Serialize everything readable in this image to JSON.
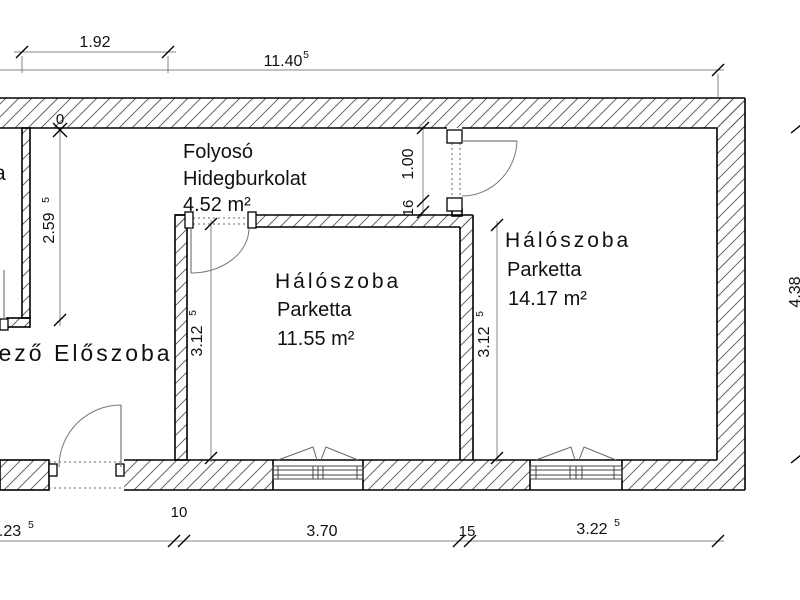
{
  "drawing_type": "floor-plan",
  "rooms": {
    "folyoso": {
      "name": "Folyosó",
      "finish": "Hidegburkolat",
      "area": "4.52 m²"
    },
    "haloszoba1": {
      "name": "Hálószoba",
      "finish": "Parketta",
      "area": "11.55 m²"
    },
    "haloszoba2": {
      "name": "Hálószoba",
      "finish": "Parketta",
      "area": "14.17 m²"
    },
    "eloszoba": {
      "name": "kező Előszoba"
    },
    "cut_room_letter": {
      "name": "a"
    }
  },
  "dims": {
    "top_192": {
      "v": "1.92",
      "s": ""
    },
    "top_1140": {
      "v": "11.40",
      "s": "5"
    },
    "zero_marker": "0",
    "left_259": {
      "v": "2.59",
      "s": "5"
    },
    "door_100": "1.00",
    "door_16": "16",
    "mid_312": {
      "v": "3.12",
      "s": "5"
    },
    "right_312": {
      "v": "3.12",
      "s": "5"
    },
    "right_438": "4.38",
    "bot_423": {
      "v": "4.23",
      "s": "5"
    },
    "bot_10": "10",
    "bot_370": "3.70",
    "bot_15": "15",
    "bot_322": {
      "v": "3.22",
      "s": "5"
    }
  },
  "colors": {
    "background": "#ffffff",
    "wall_outline": "#000000",
    "hatch": "#555555",
    "dimension_line": "#848484",
    "door_swing": "#777777",
    "text": "#111111"
  }
}
